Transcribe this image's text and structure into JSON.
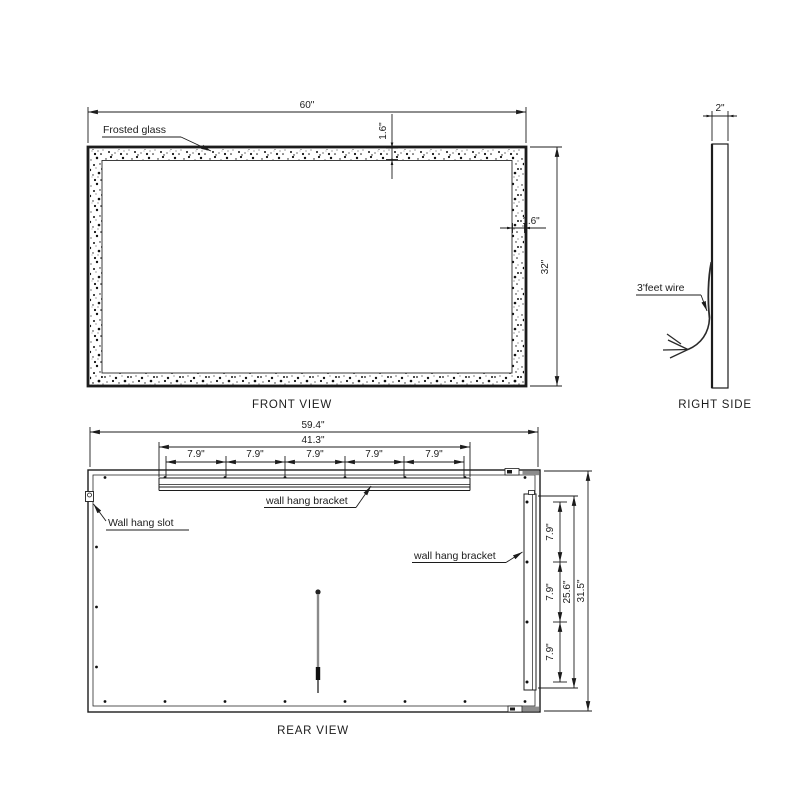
{
  "front_view": {
    "title": "FRONT VIEW",
    "labels": {
      "frosted_glass": "Frosted glass"
    },
    "dims": {
      "overall_width": "60\"",
      "overall_height": "32\"",
      "border_top": "1.6\"",
      "border_right": "1.6\""
    }
  },
  "right_side": {
    "title": "RIGHT SIDE",
    "labels": {
      "wire": "3'feet wire"
    },
    "dims": {
      "thickness": "2\""
    }
  },
  "rear_view": {
    "title": "REAR VIEW",
    "labels": {
      "wall_hang_slot": "Wall hang slot",
      "top_bracket": "wall hang bracket",
      "right_bracket": "wall hang bracket"
    },
    "dims": {
      "overall_width": "59.4\"",
      "top_bracket_width": "41.3\"",
      "top_segments": [
        "7.9\"",
        "7.9\"",
        "7.9\"",
        "7.9\"",
        "7.9\""
      ],
      "right_segments": [
        "7.9\"",
        "7.9\"",
        "7.9\""
      ],
      "right_bracket_height": "25.6\"",
      "overall_height": "31.5\""
    }
  }
}
